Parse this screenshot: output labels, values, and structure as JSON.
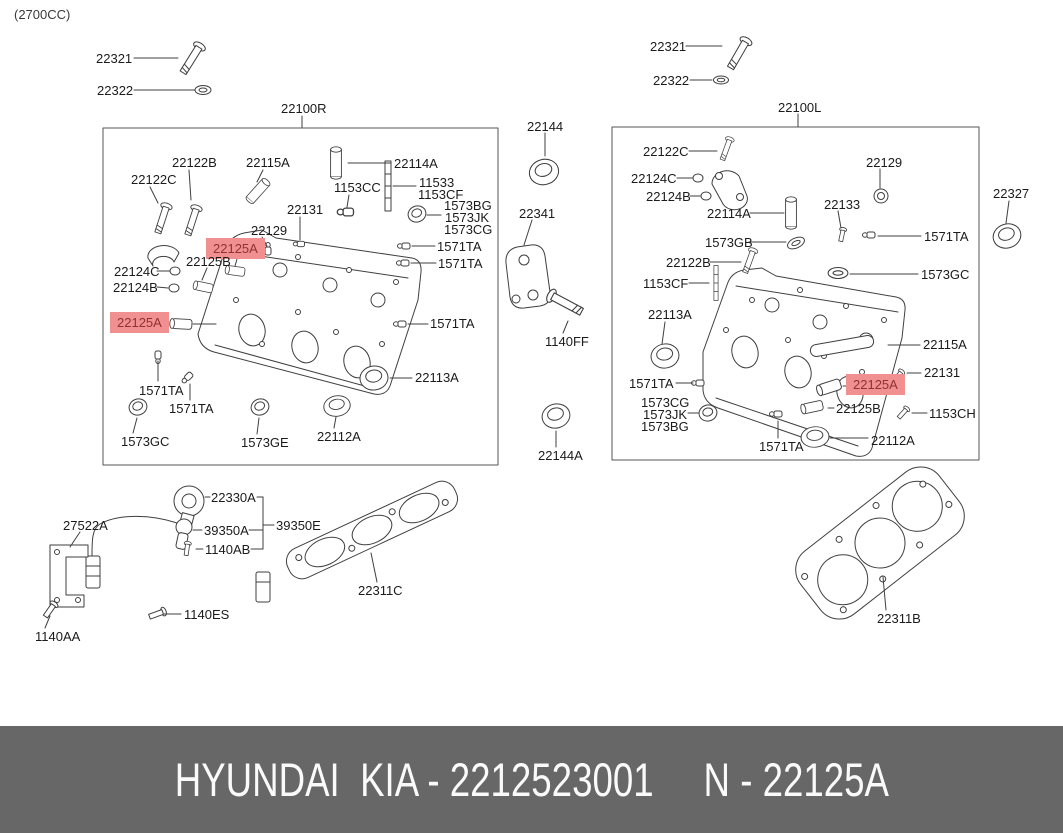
{
  "meta": {
    "engine_size": "(2700CC)"
  },
  "colors": {
    "highlight_bg": "#f19090",
    "highlight_text": "#933030",
    "banner_bg": "#676767",
    "banner_text": "#fafafa",
    "line_art": "#3f3f3f",
    "label_text": "#1b1b1b"
  },
  "banner": {
    "left": "HYUNDAI  KIA - 2212523001",
    "right": "N - 22125A"
  },
  "assemblies": {
    "left_box_title": "22100R",
    "right_box_title": "22100L",
    "highlighted_part": "22125A"
  },
  "labels": [
    {
      "t": "22321",
      "x": 96,
      "y": 52
    },
    {
      "t": "22322",
      "x": 97,
      "y": 84
    },
    {
      "t": "22100R",
      "x": 281,
      "y": 102
    },
    {
      "t": "22122B",
      "x": 172,
      "y": 156
    },
    {
      "t": "22115A",
      "x": 246,
      "y": 156
    },
    {
      "t": "22114A",
      "x": 394,
      "y": 157
    },
    {
      "t": "22122C",
      "x": 131,
      "y": 173
    },
    {
      "t": "1153CC",
      "x": 334,
      "y": 181
    },
    {
      "t": "11533",
      "x": 419,
      "y": 176
    },
    {
      "t": "1153CF",
      "x": 418,
      "y": 188
    },
    {
      "t": "22131",
      "x": 287,
      "y": 203
    },
    {
      "t": "1573BG",
      "x": 444,
      "y": 199
    },
    {
      "t": "1573JK",
      "x": 445,
      "y": 211
    },
    {
      "t": "1573CG",
      "x": 444,
      "y": 223
    },
    {
      "t": "22129",
      "x": 251,
      "y": 224
    },
    {
      "t": "22125A",
      "x": 206,
      "y": 238,
      "hl": true
    },
    {
      "t": "1571TA",
      "x": 437,
      "y": 240
    },
    {
      "t": "22125B",
      "x": 186,
      "y": 255
    },
    {
      "t": "1571TA",
      "x": 438,
      "y": 257
    },
    {
      "t": "22124C",
      "x": 114,
      "y": 265
    },
    {
      "t": "22124B",
      "x": 113,
      "y": 281
    },
    {
      "t": "22125A",
      "x": 110,
      "y": 312,
      "hl": true
    },
    {
      "t": "1571TA",
      "x": 430,
      "y": 317
    },
    {
      "t": "1571TA",
      "x": 139,
      "y": 384
    },
    {
      "t": "22113A",
      "x": 415,
      "y": 371
    },
    {
      "t": "1571TA",
      "x": 169,
      "y": 402
    },
    {
      "t": "1573GC",
      "x": 121,
      "y": 435
    },
    {
      "t": "1573GE",
      "x": 241,
      "y": 436
    },
    {
      "t": "22112A",
      "x": 317,
      "y": 430
    },
    {
      "t": "22144",
      "x": 527,
      "y": 120
    },
    {
      "t": "22341",
      "x": 519,
      "y": 207
    },
    {
      "t": "1140FF",
      "x": 545,
      "y": 335
    },
    {
      "t": "22144A",
      "x": 538,
      "y": 449
    },
    {
      "t": "22321",
      "x": 650,
      "y": 40
    },
    {
      "t": "22322",
      "x": 653,
      "y": 74
    },
    {
      "t": "22100L",
      "x": 778,
      "y": 101
    },
    {
      "t": "22122C",
      "x": 643,
      "y": 145
    },
    {
      "t": "22124C",
      "x": 631,
      "y": 172
    },
    {
      "t": "22124B",
      "x": 646,
      "y": 190
    },
    {
      "t": "22114A",
      "x": 707,
      "y": 207
    },
    {
      "t": "22129",
      "x": 866,
      "y": 156
    },
    {
      "t": "22133",
      "x": 824,
      "y": 198
    },
    {
      "t": "1573GB",
      "x": 705,
      "y": 236
    },
    {
      "t": "1571TA",
      "x": 924,
      "y": 230
    },
    {
      "t": "22327",
      "x": 993,
      "y": 187
    },
    {
      "t": "22122B",
      "x": 666,
      "y": 256
    },
    {
      "t": "1153CF",
      "x": 643,
      "y": 277
    },
    {
      "t": "1573GC",
      "x": 921,
      "y": 268
    },
    {
      "t": "22113A",
      "x": 648,
      "y": 308
    },
    {
      "t": "1571TA",
      "x": 629,
      "y": 377
    },
    {
      "t": "22115A",
      "x": 923,
      "y": 338
    },
    {
      "t": "22131",
      "x": 924,
      "y": 366
    },
    {
      "t": "22125A",
      "x": 846,
      "y": 374,
      "hl": true
    },
    {
      "t": "1573CG",
      "x": 641,
      "y": 396
    },
    {
      "t": "1573JK",
      "x": 643,
      "y": 408
    },
    {
      "t": "1573BG",
      "x": 641,
      "y": 420
    },
    {
      "t": "22125B",
      "x": 836,
      "y": 402
    },
    {
      "t": "1153CH",
      "x": 929,
      "y": 407
    },
    {
      "t": "1571TA",
      "x": 759,
      "y": 440
    },
    {
      "t": "22112A",
      "x": 871,
      "y": 434
    },
    {
      "t": "22330A",
      "x": 211,
      "y": 491
    },
    {
      "t": "27522A",
      "x": 63,
      "y": 519
    },
    {
      "t": "39350A",
      "x": 204,
      "y": 524
    },
    {
      "t": "39350E",
      "x": 276,
      "y": 519
    },
    {
      "t": "1140AB",
      "x": 205,
      "y": 543
    },
    {
      "t": "1140ES",
      "x": 184,
      "y": 608
    },
    {
      "t": "1140AA",
      "x": 35,
      "y": 630
    },
    {
      "t": "22311C",
      "x": 358,
      "y": 584
    },
    {
      "t": "22311B",
      "x": 877,
      "y": 612
    }
  ]
}
